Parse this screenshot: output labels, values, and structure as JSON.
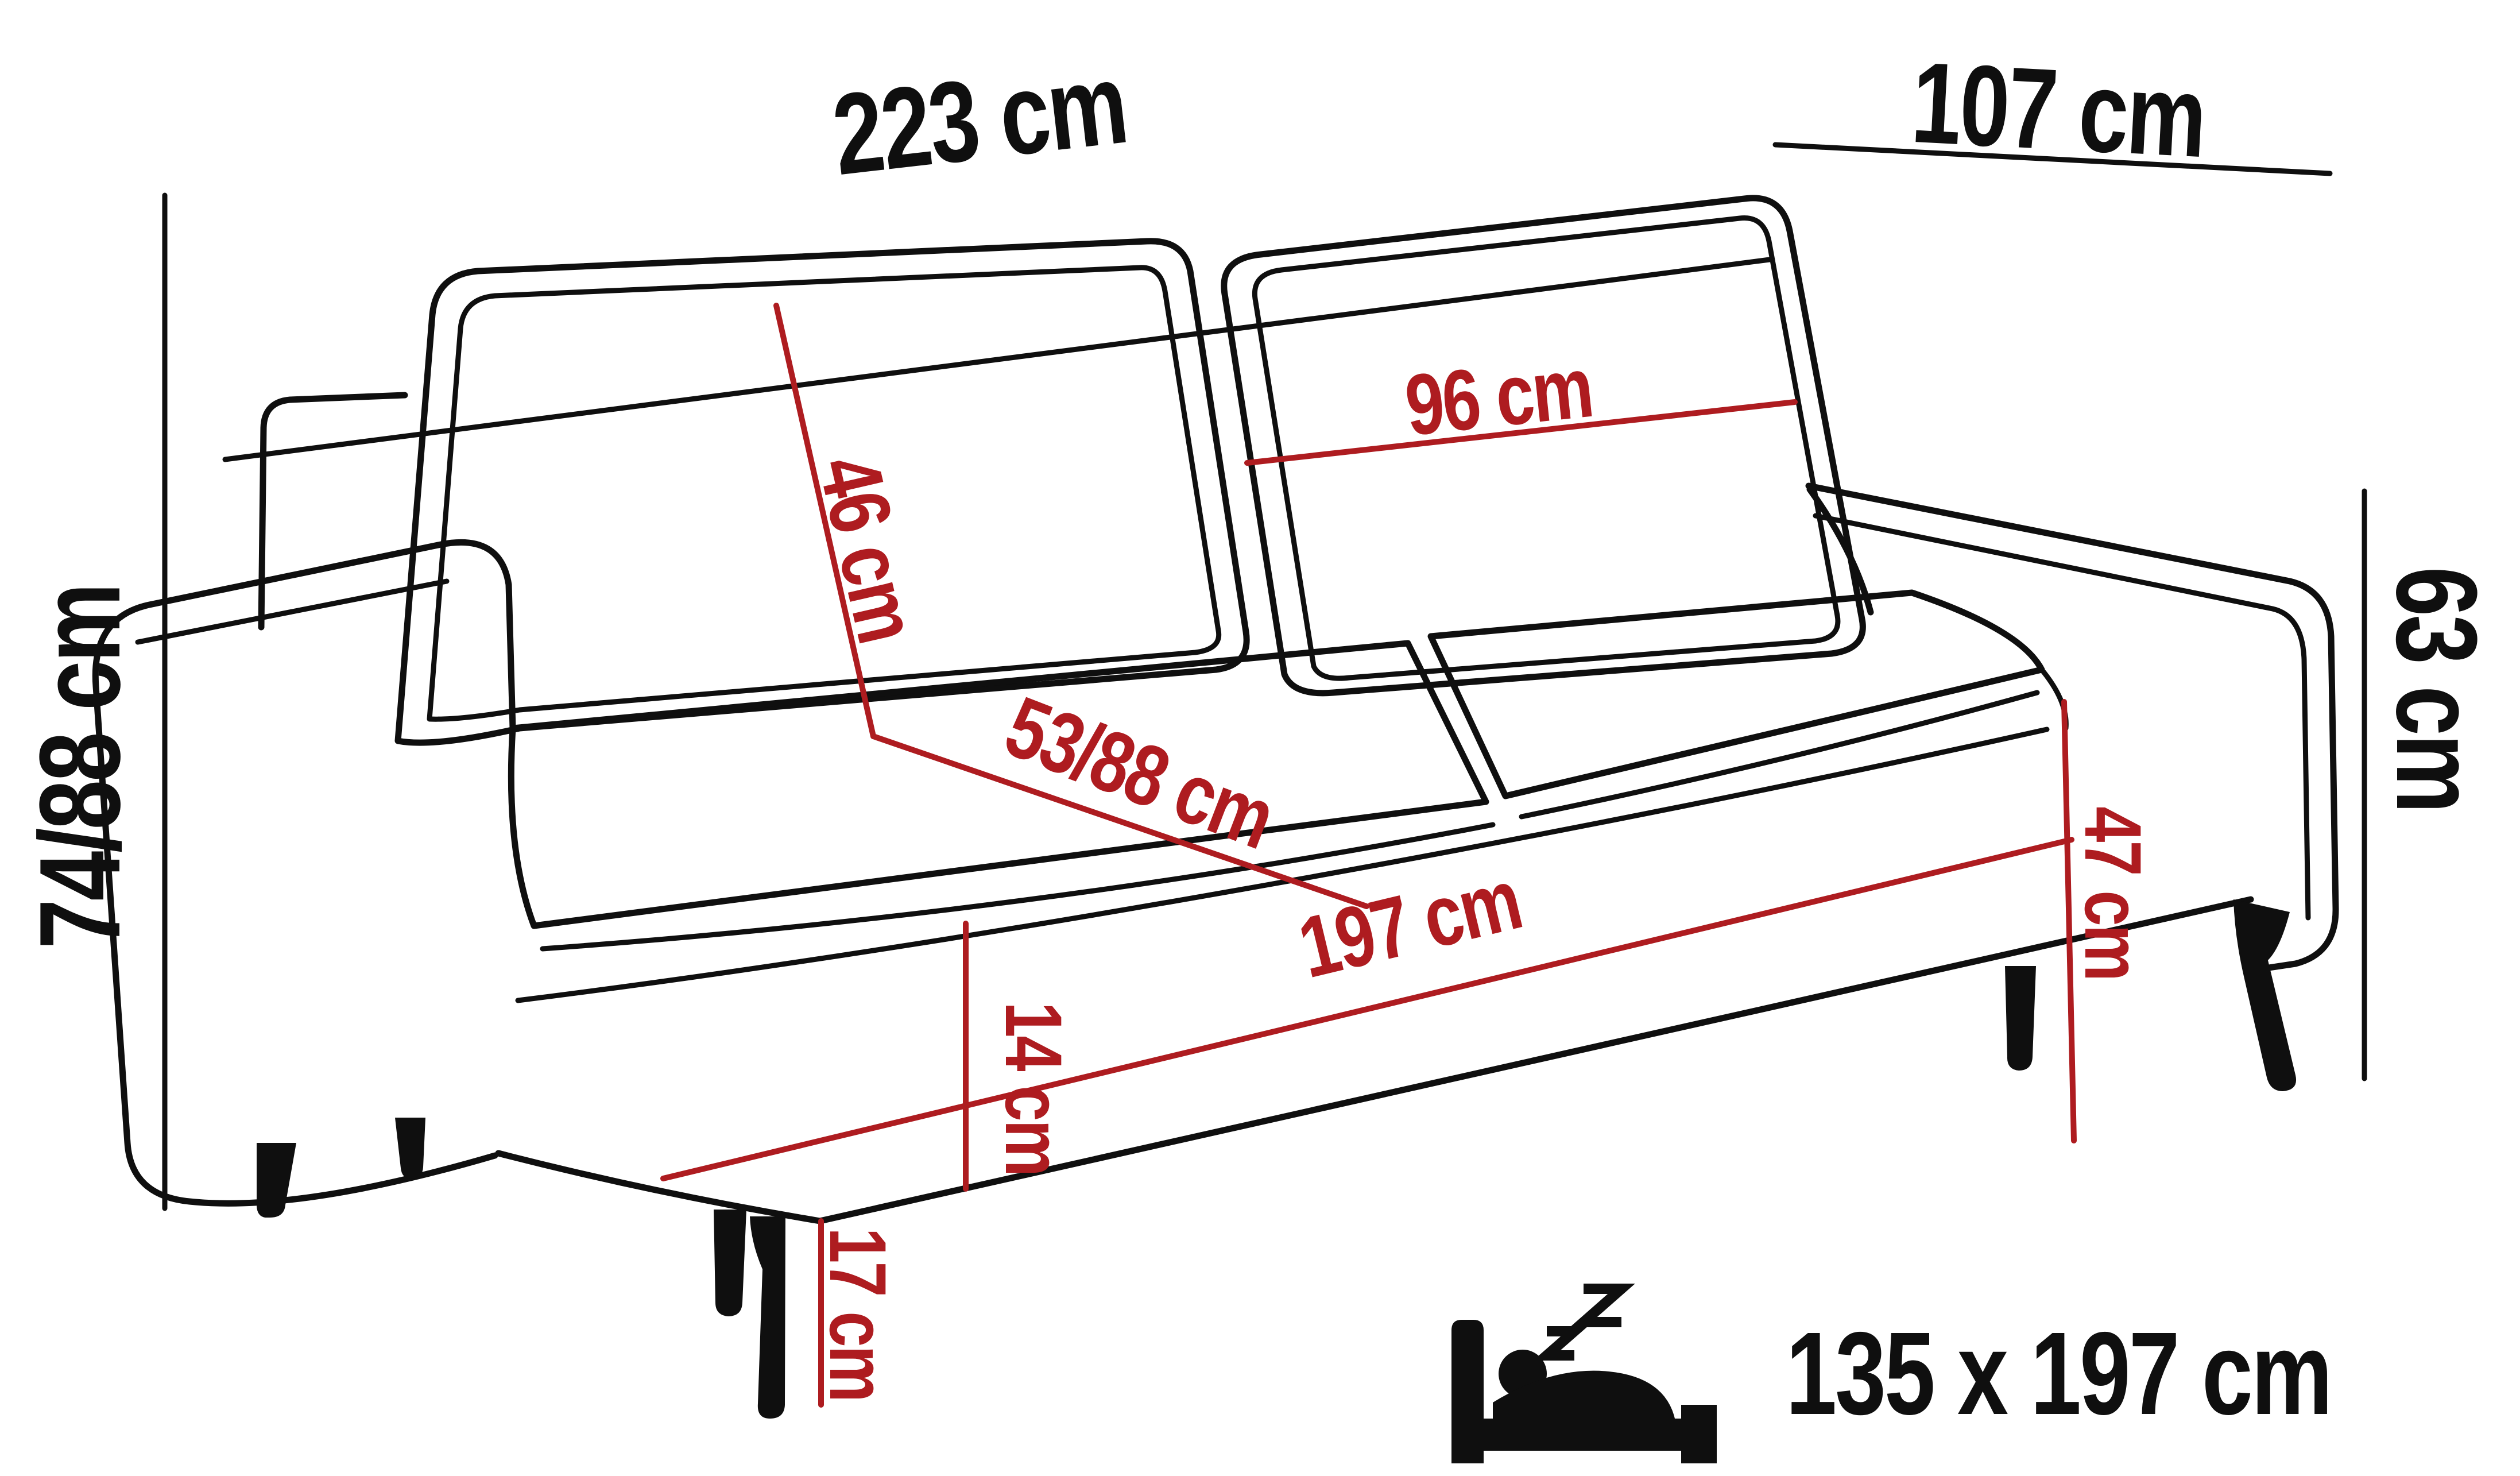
{
  "diagram": {
    "title_hint": "sofa-bed dimension drawing",
    "colors": {
      "outline": "#0f0f0f",
      "dimension_red": "#ae1c20",
      "background": "#ffffff"
    },
    "dimensions_black": {
      "overall_width": "223 cm",
      "overall_depth": "107 cm",
      "overall_height": "74/88 cm",
      "arm_side_height": "63 cm"
    },
    "dimensions_red": {
      "back_cushion_height": "46 cm",
      "back_cushion_width": "96 cm",
      "seat_depth": "53/88 cm",
      "seat_front_width": "197 cm",
      "base_front_height": "14 cm",
      "seat_height": "47 cm",
      "leg_height": "17 cm"
    },
    "sleeping_function": {
      "icon": "sleep-bed-icon",
      "area_label": "135 x 197 cm"
    }
  }
}
